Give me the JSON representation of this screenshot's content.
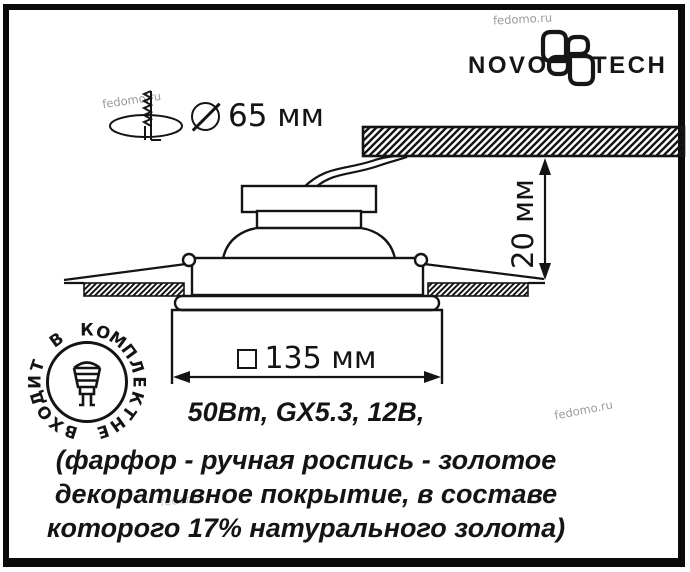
{
  "watermark": "fedomo.ru",
  "brand": {
    "wordmark_left": "NOVO",
    "wordmark_right": "TECH"
  },
  "dims": {
    "hole_diameter": "65 мм",
    "recess_depth": "20 мм",
    "face_size": "135 мм"
  },
  "specs": {
    "power_line": "50Вт, GX5.3, 12В,",
    "desc_line1": "(фарфор - ручная роспись - золотое",
    "desc_line2": "декоративное покрытие, в составе",
    "desc_line3": "которого 17% натурального золота)"
  },
  "stamp": {
    "ring_text": "НЕ ВХОДИТ В КОМПЛЕКТ"
  },
  "colors": {
    "ink": "#141414",
    "watermark": "#9b9b9b"
  }
}
